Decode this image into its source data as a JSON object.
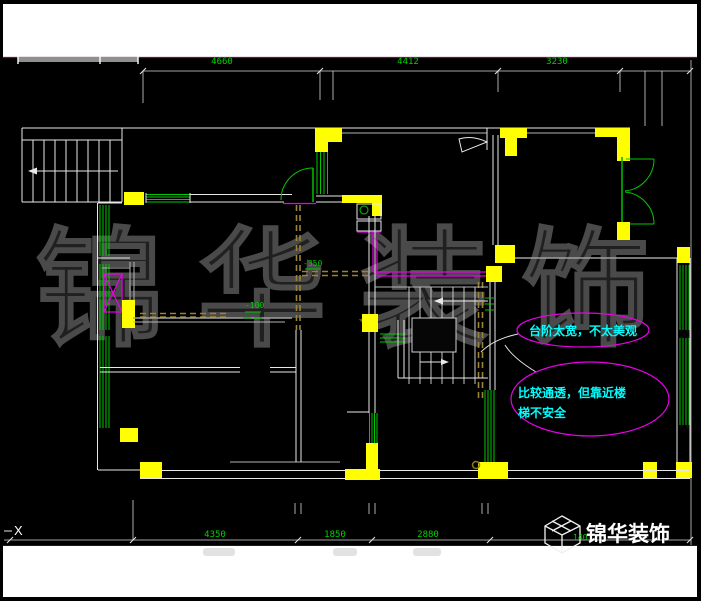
{
  "watermark": {
    "chars": [
      "锦",
      "华",
      "装",
      "饰"
    ],
    "color": "#4a4a4a"
  },
  "dims": {
    "color": "#00d200",
    "top": [
      "4660",
      "4412",
      "3230"
    ],
    "bottom": [
      "4350",
      "1850",
      "2880"
    ]
  },
  "levels": {
    "label1": "-350",
    "label2": "-100"
  },
  "axis": {
    "x_marker": "X"
  },
  "notes": {
    "ellipse_color": "#e800e8",
    "text_color": "#00ffff",
    "note1": "台阶太宽，不太美观",
    "note2_line1": "比较通透，但靠近楼",
    "note2_line2": "梯不安全"
  },
  "logo": {
    "name": "锦华装饰",
    "tiny_dim": "140",
    "color": "#ffffff"
  },
  "palette": {
    "background": "#000000",
    "walls": "#e8e8e8",
    "columns": "#ffff00",
    "windows_doors": "#00c800",
    "shaft_walls": "#e800e8",
    "hidden_lines": "#9b8433",
    "page_margin": "#ffffff",
    "border_line": "#6e1430"
  }
}
